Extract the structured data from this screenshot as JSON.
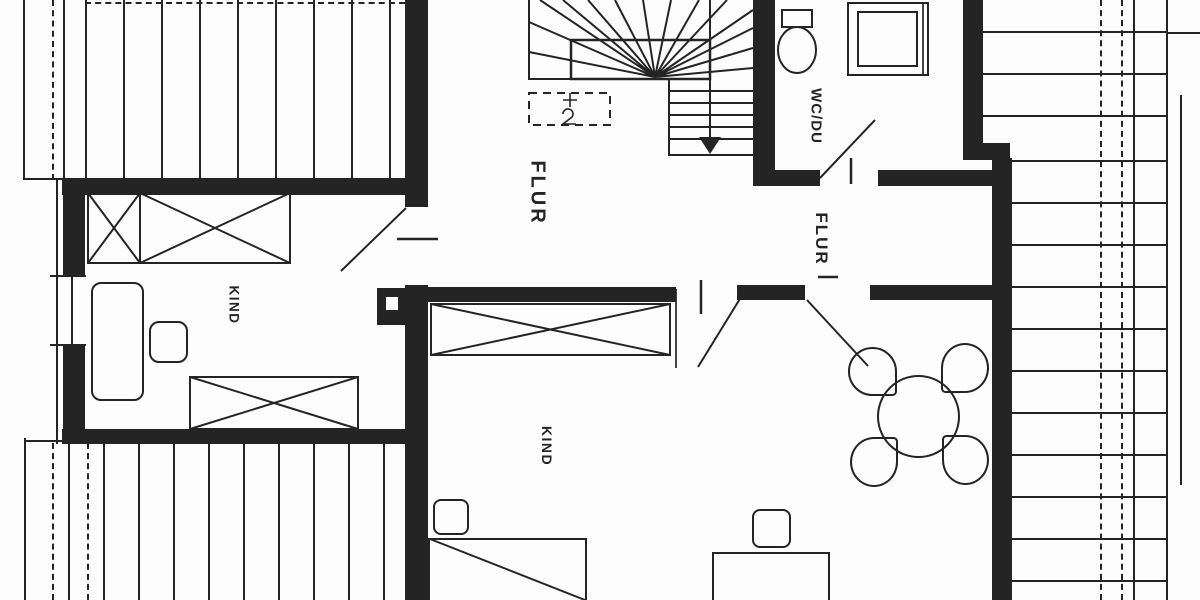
{
  "rooms": {
    "hall_center": {
      "label": "FLUR"
    },
    "hall_right": {
      "label": "FLUR"
    },
    "bathroom": {
      "label": "WC/DU"
    },
    "child_left": {
      "label": "KIND"
    },
    "child_bottom": {
      "label": "KIND"
    }
  },
  "colors": {
    "ink": "#242424",
    "paper": "#fdfdfd"
  }
}
